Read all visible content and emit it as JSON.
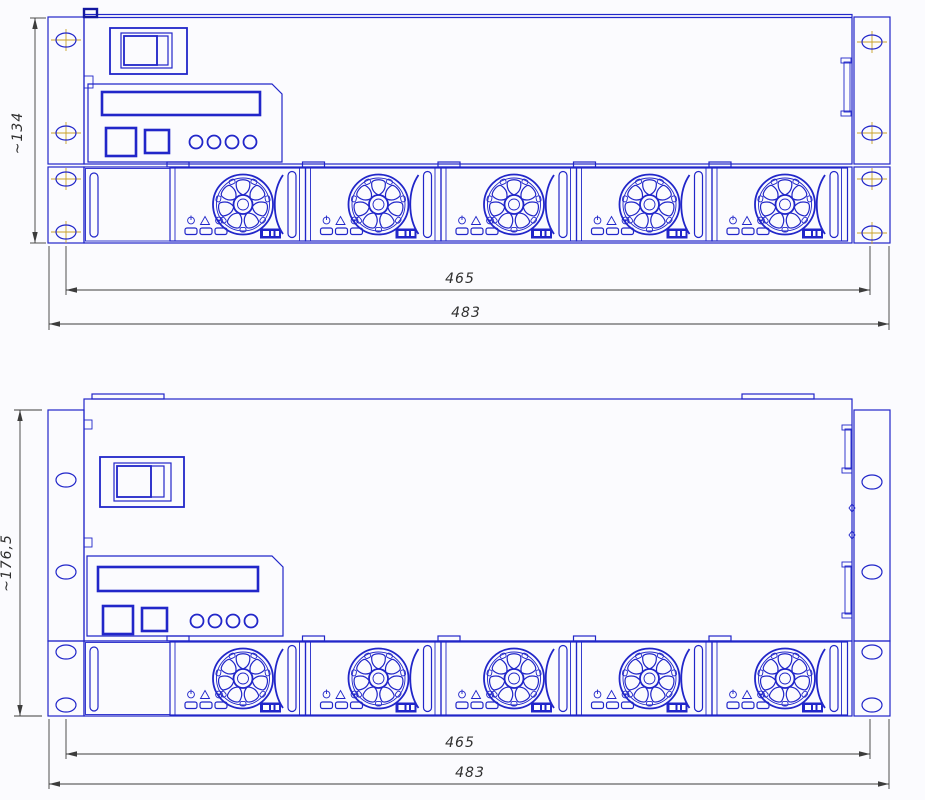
{
  "views": [
    {
      "height_dim": "~134",
      "width_dim_inner": "465",
      "width_dim_outer": "483"
    },
    {
      "height_dim": "~176,5",
      "width_dim_inner": "465",
      "width_dim_outer": "483"
    }
  ],
  "colors": {
    "line-blue": "#2126c9",
    "line-navy": "#1317a0",
    "dim-color": "#3c3c3c",
    "centerline-color": "#c9a227",
    "bg": "#fbfbfe"
  }
}
